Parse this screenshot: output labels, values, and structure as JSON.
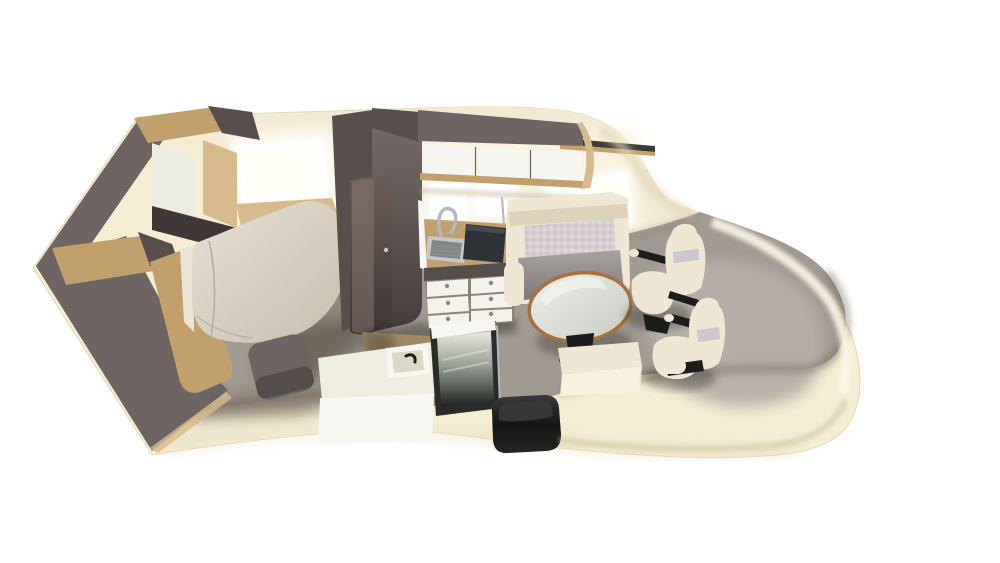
{
  "scene": {
    "label": "Motorhome interior 3D cutaway floor plan render",
    "rooms": [
      "bedroom",
      "kitchen",
      "bathroom",
      "dinette",
      "cab"
    ]
  },
  "parts": {
    "bedroom": [
      "double-bed",
      "headboard-shelf",
      "window"
    ],
    "kitchen": [
      "overhead-lockers",
      "sink",
      "hob",
      "drawer-unit",
      "tap",
      "worktop"
    ],
    "bathroom": [
      "washbasin-vanity",
      "shower-mirror-panel",
      "door",
      "wardrobe"
    ],
    "dinette": [
      "bench-seat",
      "pedestal-table",
      "side-bench",
      "window"
    ],
    "cab": [
      "swivel-seat-rear",
      "swivel-seat-front",
      "carpet"
    ],
    "entrance": [
      "entry-step"
    ]
  },
  "palette": {
    "background": "#ffffff",
    "shell": "#f4edd2",
    "shell_rim_light": "#faf6e6",
    "shell_shadow": "#d9cfae",
    "wall": "#f2e9d2",
    "wall_glow": "#faf4e2",
    "window": "#ffffff",
    "wood_light": "#d7ba8b",
    "wood_mid": "#c2a06c",
    "wood_dark": "#a07c49",
    "taupe_light": "#7b716e",
    "taupe": "#6e6461",
    "taupe_dark": "#584e4c",
    "panel_white": "#ecece2",
    "mattress_side": "#eae4d4",
    "carpet": "#a49c93",
    "carpet_warm": "#8e8274",
    "carpet_light": "#b7b0a8",
    "carpet_dark": "#6f675f",
    "seat_cream": "#efe7d4",
    "seat_cream_shade": "#ddd2ba",
    "cushion_check": "#d8ced2",
    "lavender": "#cbc2ca",
    "table_rim": "#a5713d",
    "drawer_white": "#f4f2eb",
    "cabinet_door_white": "#f7f5ef",
    "drawer_top_band": "#564e4b",
    "knob": "#8f8984",
    "steel": "#c6c8c8",
    "steel_dark": "#848787",
    "cooktop": "#2d3237",
    "vanity_white": "#f7f6f1",
    "basin": "#efede0",
    "black": "#1c1c1c",
    "roof_trim": "#3e3a36",
    "mirror_frame": "#2b2b29"
  }
}
